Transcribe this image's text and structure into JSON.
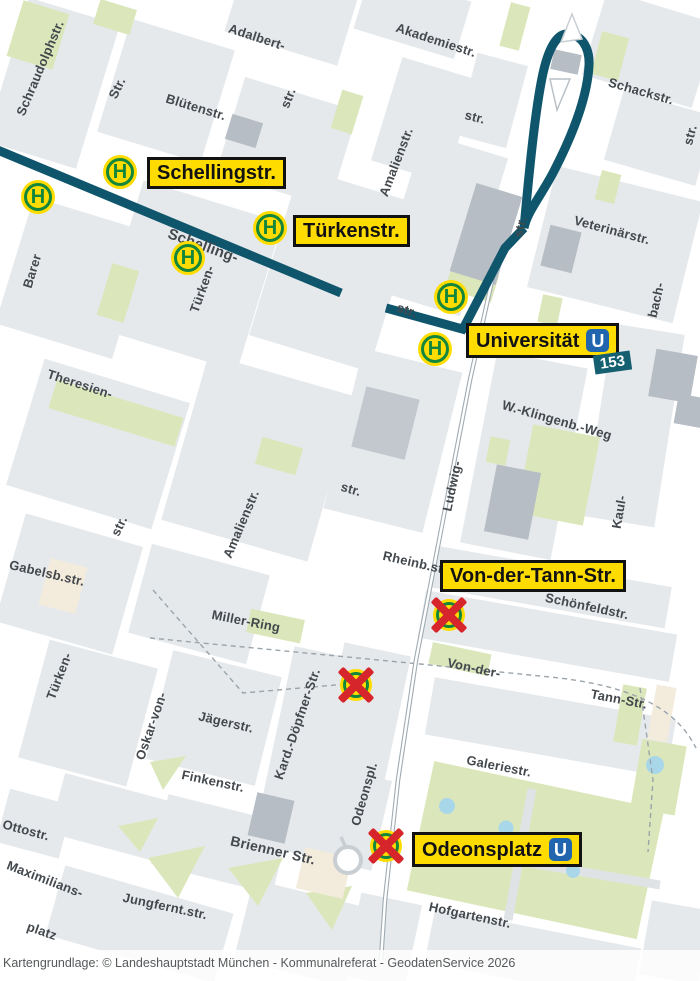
{
  "map": {
    "attribution": "Kartengrundlage: © Landeshauptstadt München - Kommunalreferat - GeodatenService 2026",
    "route_badge": "153",
    "ubahn_symbol": "U",
    "stop_symbol": "H",
    "colors": {
      "route_teal": "#0f566c",
      "stop_yellow": "#ffdc00",
      "stop_green": "#12863c",
      "cancel_red": "#d6252b",
      "ubahn_blue": "#2065ad",
      "badge_teal": "#156070",
      "park_green": "#dbe7ba",
      "water_blue": "#a9d7ea",
      "block_gray": "#e6e9ec",
      "building_gray": "#b6bdc5"
    },
    "stop_labels": [
      {
        "name": "Schellingstr.",
        "x": 147,
        "y": 157,
        "ubahn": false
      },
      {
        "name": "Türkenstr.",
        "x": 293,
        "y": 215,
        "ubahn": false
      },
      {
        "name": "Universität",
        "x": 466,
        "y": 323,
        "ubahn": true
      },
      {
        "name": "Von-der-Tann-Str.",
        "x": 440,
        "y": 560,
        "ubahn": false
      },
      {
        "name": "Odeonsplatz",
        "x": 412,
        "y": 832,
        "ubahn": true
      }
    ],
    "active_stops": [
      {
        "x": 120,
        "y": 172
      },
      {
        "x": 38,
        "y": 197
      },
      {
        "x": 188,
        "y": 258
      },
      {
        "x": 270,
        "y": 228
      },
      {
        "x": 451,
        "y": 297
      },
      {
        "x": 435,
        "y": 349
      }
    ],
    "cancelled_stops": [
      {
        "x": 449,
        "y": 615
      },
      {
        "x": 356,
        "y": 685
      },
      {
        "x": 386,
        "y": 846
      }
    ],
    "street_labels": [
      {
        "text": "Schraudolphstr.",
        "x": 40,
        "y": 68,
        "rot": -67,
        "size": 13
      },
      {
        "text": "Str.",
        "x": 117,
        "y": 88,
        "rot": -64,
        "size": 13
      },
      {
        "text": "Adalbert-",
        "x": 257,
        "y": 37,
        "rot": 18,
        "size": 13
      },
      {
        "text": "str.",
        "x": 288,
        "y": 98,
        "rot": -68,
        "size": 13
      },
      {
        "text": "Blütenstr.",
        "x": 196,
        "y": 107,
        "rot": 17,
        "size": 13
      },
      {
        "text": "Akademiestr.",
        "x": 436,
        "y": 40,
        "rot": 18,
        "size": 13
      },
      {
        "text": "str.",
        "x": 475,
        "y": 117,
        "rot": 14,
        "size": 13
      },
      {
        "text": "Schackstr.",
        "x": 641,
        "y": 91,
        "rot": 16,
        "size": 13
      },
      {
        "text": "str.",
        "x": 690,
        "y": 135,
        "rot": -75,
        "size": 13
      },
      {
        "text": "Amalienstr.",
        "x": 396,
        "y": 162,
        "rot": -69,
        "size": 13
      },
      {
        "text": "str.",
        "x": 520,
        "y": 227,
        "rot": -78,
        "size": 13
      },
      {
        "text": "Veterinärstr.",
        "x": 612,
        "y": 230,
        "rot": 15,
        "size": 13
      },
      {
        "text": "Schelling-",
        "x": 203,
        "y": 246,
        "rot": 20,
        "size": 15
      },
      {
        "text": "Barer",
        "x": 32,
        "y": 271,
        "rot": -73,
        "size": 13
      },
      {
        "text": "Türken-",
        "x": 202,
        "y": 289,
        "rot": -70,
        "size": 13
      },
      {
        "text": "bach-",
        "x": 656,
        "y": 300,
        "rot": -77,
        "size": 13
      },
      {
        "text": "str.",
        "x": 407,
        "y": 310,
        "rot": 19,
        "size": 13
      },
      {
        "text": "Theresien-",
        "x": 80,
        "y": 384,
        "rot": 18,
        "size": 13
      },
      {
        "text": "W.-Klingenb.-Weg",
        "x": 557,
        "y": 420,
        "rot": 16,
        "size": 13
      },
      {
        "text": "str.",
        "x": 351,
        "y": 489,
        "rot": 16,
        "size": 13
      },
      {
        "text": "Ludwig-",
        "x": 452,
        "y": 486,
        "rot": -78,
        "size": 13
      },
      {
        "text": "Kaul-",
        "x": 619,
        "y": 512,
        "rot": -80,
        "size": 13
      },
      {
        "text": "str.",
        "x": 119,
        "y": 526,
        "rot": -64,
        "size": 13
      },
      {
        "text": "Amalienstr.",
        "x": 241,
        "y": 524,
        "rot": -67,
        "size": 13
      },
      {
        "text": "Rheinb.str.",
        "x": 417,
        "y": 563,
        "rot": 13,
        "size": 13
      },
      {
        "text": "Gabelsb.str.",
        "x": 47,
        "y": 573,
        "rot": 13,
        "size": 13
      },
      {
        "text": "Schönfeldstr.",
        "x": 587,
        "y": 606,
        "rot": 12,
        "size": 13
      },
      {
        "text": "Miller-Ring",
        "x": 246,
        "y": 621,
        "rot": 11,
        "size": 13
      },
      {
        "text": "Von-der-",
        "x": 474,
        "y": 668,
        "rot": 12,
        "size": 13
      },
      {
        "text": "Tann-Str.",
        "x": 619,
        "y": 699,
        "rot": 11,
        "size": 13
      },
      {
        "text": "Türken-",
        "x": 59,
        "y": 676,
        "rot": -69,
        "size": 13
      },
      {
        "text": "Oskar-von-",
        "x": 151,
        "y": 726,
        "rot": -71,
        "size": 13
      },
      {
        "text": "Jägerstr.",
        "x": 226,
        "y": 722,
        "rot": 13,
        "size": 13
      },
      {
        "text": "Kard.-Döpfner-Str.",
        "x": 297,
        "y": 724,
        "rot": -71,
        "size": 13
      },
      {
        "text": "Finkenstr.",
        "x": 213,
        "y": 781,
        "rot": 12,
        "size": 13
      },
      {
        "text": "Odeonspl.",
        "x": 364,
        "y": 794,
        "rot": -74,
        "size": 13
      },
      {
        "text": "Galeriestr.",
        "x": 499,
        "y": 766,
        "rot": 11,
        "size": 13
      },
      {
        "text": "Ottostr.",
        "x": 26,
        "y": 830,
        "rot": 15,
        "size": 13
      },
      {
        "text": "Brienner Str.",
        "x": 273,
        "y": 850,
        "rot": 13,
        "size": 14
      },
      {
        "text": "Maximilians-",
        "x": 45,
        "y": 879,
        "rot": 21,
        "size": 13
      },
      {
        "text": "platz",
        "x": 42,
        "y": 931,
        "rot": 19,
        "size": 13
      },
      {
        "text": "Jungfernt.str.",
        "x": 165,
        "y": 906,
        "rot": 12,
        "size": 13
      },
      {
        "text": "Hofgartenstr.",
        "x": 470,
        "y": 915,
        "rot": 12,
        "size": 13
      }
    ]
  }
}
